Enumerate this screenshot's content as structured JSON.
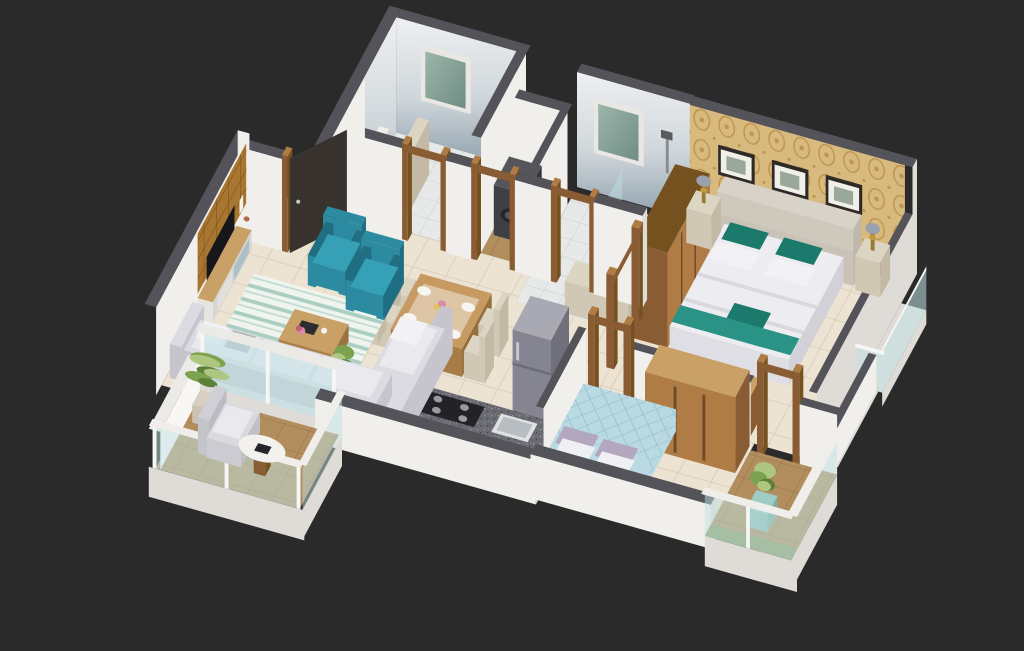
{
  "scene": {
    "kind": "isometric-3d-floor-plan-render",
    "background": "#2a2a2a",
    "rooms": [
      {
        "id": "living-room",
        "objects": [
          "tv-unit-wood-panel-wall",
          "television",
          "two-teal-accent-armchairs",
          "striped-rug",
          "wooden-coffee-table",
          "l-shaped-gray-sofa",
          "potted-plant"
        ]
      },
      {
        "id": "entrance-foyer",
        "objects": [
          "open-dark-entry-door",
          "wood-door-frame"
        ]
      },
      {
        "id": "common-bathroom",
        "objects": [
          "toilet",
          "window",
          "tiled-wall",
          "half-partition"
        ]
      },
      {
        "id": "utility",
        "objects": [
          "washing-machine",
          "brown-tile-floor",
          "door-frame"
        ]
      },
      {
        "id": "master-bathroom",
        "objects": [
          "shower",
          "window",
          "tiled-wall",
          "basin-counter",
          "glass-screen"
        ]
      },
      {
        "id": "master-bedroom",
        "objects": [
          "gold-damask-wallpaper-wall",
          "three-picture-frames",
          "double-bed-teal-pillows",
          "tufted-headboard",
          "two-nightstands-with-lamps",
          "tall-wardrobe",
          "sideboard"
        ]
      },
      {
        "id": "second-bedroom",
        "objects": [
          "double-bed-blue-diamond-duvet",
          "lavender-pillows",
          "sliding-door-wardrobe"
        ]
      },
      {
        "id": "kitchen",
        "objects": [
          "granite-counter",
          "gas-stove",
          "sink",
          "fruit-basket",
          "refrigerator"
        ]
      },
      {
        "id": "dining-area",
        "objects": [
          "wooden-table",
          "four-cream-chairs",
          "place-settings",
          "flower-vase"
        ]
      },
      {
        "id": "balcony-left",
        "objects": [
          "palm-plant",
          "lounge-armchair",
          "round-white-table",
          "glass-railing",
          "brown-tile-floor"
        ]
      },
      {
        "id": "balcony-right",
        "objects": [
          "potted-shrub",
          "glass-railing",
          "brown-tile-floor",
          "green-tile-edge"
        ]
      },
      {
        "id": "side-balcony-strip",
        "objects": [
          "glass-railing"
        ]
      }
    ]
  },
  "palette": {
    "background": "#2a2a2a",
    "wallTop": "#55535a",
    "wallFace": "#f1efeb",
    "wallFaceShade": "#dfdcd7",
    "wallFaceBright": "#f8f7f4",
    "floorCream": "#ece3d3",
    "tileLine": "#d2c5b0",
    "floorBath": "#e7e9e9",
    "bathLine": "#c7cdd0",
    "floorBrown": "#b28e5e",
    "brownLine": "#93744a",
    "floorGreen": "#8d9a63",
    "tileTop": "#eef0f1",
    "tileBottom": "#8fa0ad",
    "windowGlassA": "#9db5aa",
    "windowGlassB": "#6f8d84",
    "windowFrame": "#e8e7e4",
    "wood": "#8a5c33",
    "woodMid": "#b07c45",
    "woodLight": "#c9a066",
    "woodDark": "#74511e",
    "woodPanel": "#a9762f",
    "doorLeaf": "#38332f",
    "teal": "#2c8ba1",
    "tealDark": "#1f6e82",
    "tealSeat": "#36a0b6",
    "sofaBody": "#dcdbe1",
    "sofaShade": "#c6c5cd",
    "cushion": "#eae9ee",
    "pillowGray": "#b9b9c2",
    "rugBase": "#eff4ef",
    "rugStripe": "#9fc8ba",
    "counterTop": "#6a6a72",
    "stove": "#232327",
    "burner": "#9a9aa2",
    "sinkSteel": "#dfe1e3",
    "sinkInner": "#b7bdc0",
    "cabinetGlass": "#aed3d2",
    "fridgeTop": "#a9a9b3",
    "fridgeFront": "#858591",
    "fridgeSide": "#70707b",
    "wallpaper": "#d9ba7e",
    "wallpaperPattern": "#bd9751",
    "headboard": "#d5cec4",
    "duvet": "#ededf1",
    "duvetShade": "#d8d8de",
    "pillowTeal": "#1b7a6c",
    "pillowWhite": "#f2f1f5",
    "bedRunnerTeal": "#2a9386",
    "cream": "#ddd5c4",
    "creamFront": "#d0c7b4",
    "creamSide": "#c3b9a5",
    "bed2Duvet": "#b9d9e3",
    "bed2Pattern": "#93c0cf",
    "pillowLav": "#b3a7c0",
    "bed2Teal": "#3aa096",
    "glass": "#bfe2e4",
    "glassFrame": "#f6f6f4",
    "plantGreen": "#7da24f",
    "plantLight": "#aec780",
    "plantDark": "#5c8038",
    "potWhite": "#e9efe9",
    "potTeal": "#9fccc3",
    "lampGold": "#c19a3f",
    "lampShade": "#9aa0ac",
    "applianceTop": "#55555c",
    "applianceFront": "#3f3f46",
    "applianceSide": "#34343a",
    "applianceDark": "#26262b",
    "frameDark": "#2e2a26",
    "frameInner": "#f1efe9",
    "tvScreen": "#17171b",
    "drawerBlue": "#aebfc6"
  }
}
